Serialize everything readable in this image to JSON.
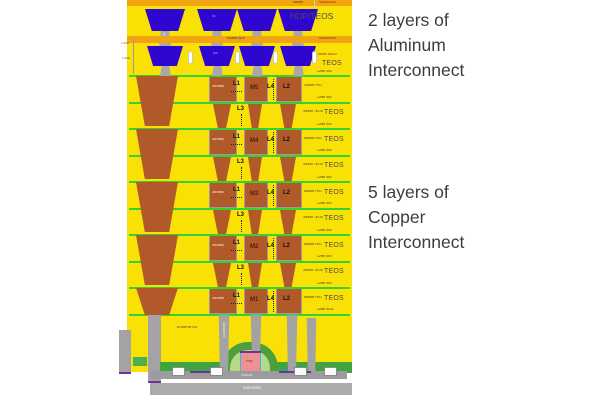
{
  "right_annotations": {
    "aluminum": [
      "2 layers of",
      "Aluminum",
      "Interconnect"
    ],
    "copper": [
      "5 layers of",
      "Copper",
      "Interconnect"
    ]
  },
  "aluminum_section": {
    "cap1": "Si3N4/SiO2",
    "cap2": "Si3N4/SiO2",
    "dim_500nm": "500nm",
    "hdp_teos": "HDP/TEOS",
    "dim_600nm": "600nm HDP",
    "max2": "780nm MAX2",
    "teos": "TEOS",
    "m7": "M7",
    "m6": "M6",
    "via6": "Via6",
    "via5": "Via5",
    "dim_a": "2.630",
    "dim_b": "1.630"
  },
  "copper_stack": {
    "metal_rows": [
      {
        "seal": "3M seal",
        "l1": "L1",
        "m": "M5",
        "l4": "L4",
        "l2": "L2",
        "sin_top": "12nm SiN",
        "fsg": "150nm FSG",
        "teos_big": "",
        "sin_bot": "12nm SiN"
      },
      {
        "seal": "3M seal",
        "l1": "L1",
        "m": "M4",
        "l4": "L4",
        "l2": "L2",
        "sin_top": "12nm SiN",
        "fsg": "550nm FSG",
        "teos_big": "TEOS",
        "sin_bot": "12nm SiN"
      },
      {
        "seal": "3M seal",
        "l1": "L1",
        "m": "M3",
        "l4": "L4",
        "l2": "L2",
        "sin_top": "12nm SiN",
        "fsg": "550nm FSG",
        "teos_big": "TEOS",
        "sin_bot": "12nm SiN"
      },
      {
        "seal": "3M seal",
        "l1": "L1",
        "m": "M2",
        "l4": "L4",
        "l2": "L2",
        "sin_top": "12nm SiN",
        "fsg": "550nm FSG",
        "teos_big": "TEOS",
        "sin_bot": "12nm SiN"
      },
      {
        "seal": "3M seal",
        "l1": "L1",
        "m": "M1",
        "l4": "L4",
        "l2": "L2",
        "sin_top": "12nm SiN",
        "fsg": "550nm FSG",
        "teos_big": "TEOS",
        "sin_bot": "12nm SiO2"
      }
    ],
    "via_rows": [
      {
        "l3": "L3",
        "teos_small": "300nm TEOS",
        "teos_big": "TEOS"
      },
      {
        "l3": "L3",
        "teos_small": "300nm TEOS",
        "teos_big": "TEOS"
      },
      {
        "l3": "L3",
        "teos_small": "300nm TEOS",
        "teos_big": "TEOS"
      },
      {
        "l3": "L3",
        "teos_small": "300nm TEOS",
        "teos_big": "TEOS"
      }
    ]
  },
  "bottom_section": {
    "bpsg": "870nm BPSG",
    "contact_w": "Contact W",
    "poly": "Poly",
    "salicide": "Salicide",
    "ct_w_left": "CT W",
    "ct_w_right": "CT W",
    "substrate": "Substrate"
  }
}
